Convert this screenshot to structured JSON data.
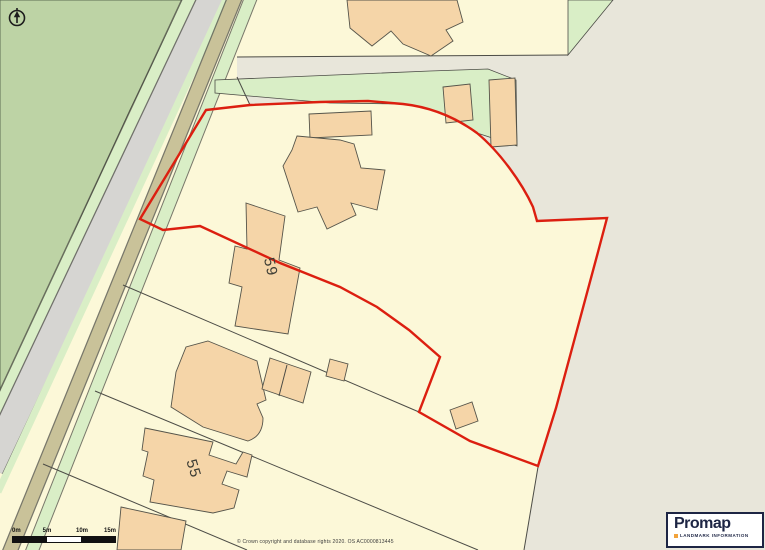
{
  "map": {
    "labels": {
      "building_59": "59",
      "building_55": "55"
    },
    "colors": {
      "woodland": "#bdd3a5",
      "edge_green": "#5d6e52",
      "verge_green": "#d9eec6",
      "road_gray": "#d6d5d2",
      "road_edge": "#70706a",
      "path_tan": "#c9c299",
      "parcel_cream": "#fcf8d8",
      "open_gray": "#e8e6da",
      "building_fill": "#f5d5a8",
      "building_outline": "#55544a",
      "boundary_red": "#dc1f10",
      "line_dark": "#4c4c46",
      "label_color": "#3c3c34",
      "logo_navy": "#1d2544",
      "logo_orange": "#f2a33c"
    }
  },
  "scalebar": {
    "labels": [
      "0m",
      "5m",
      "10m",
      "15m"
    ]
  },
  "attribution": {
    "copyright": "© Crown copyright and database rights 2020. OS AC0000813445"
  },
  "logo": {
    "name": "Promap",
    "tagline": "LANDMARK INFORMATION"
  }
}
